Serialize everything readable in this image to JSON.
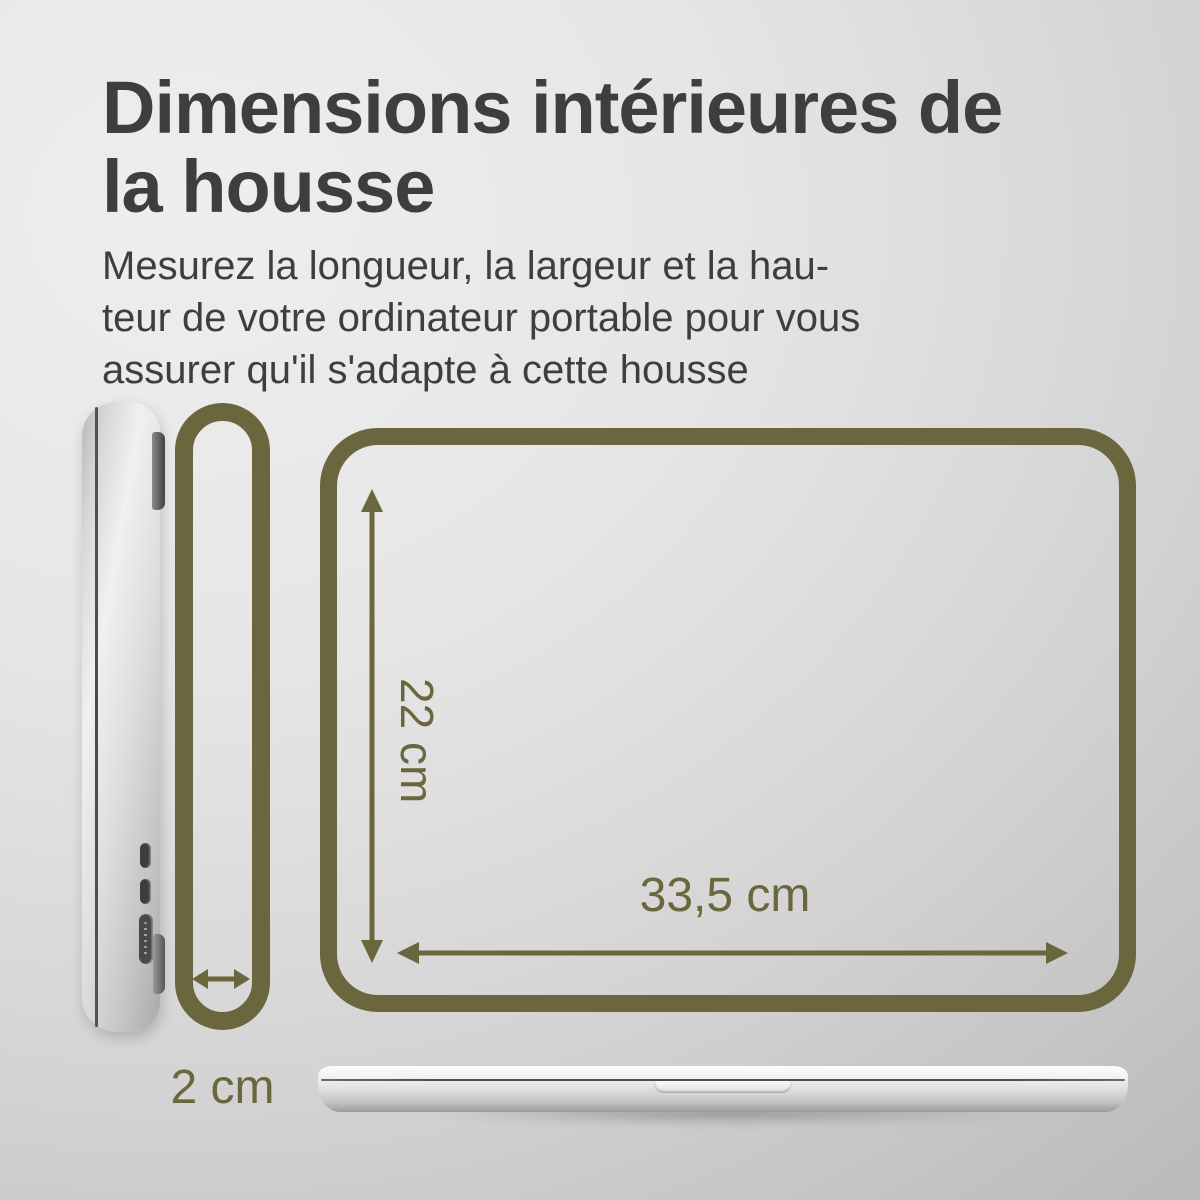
{
  "page": {
    "title": "Dimensions intérieures de\nla housse",
    "subtitle": "Mesurez la longueur, la largeur et la hau-\nteur de votre ordinateur portable pour vous\nassurer qu'il s'adapte à cette housse"
  },
  "dimensions": {
    "height_label": "22 cm",
    "width_label": "33,5 cm",
    "depth_label": "2 cm"
  },
  "colors": {
    "accent_olive": "#6a673f",
    "text_dark": "#3e3e3e"
  }
}
